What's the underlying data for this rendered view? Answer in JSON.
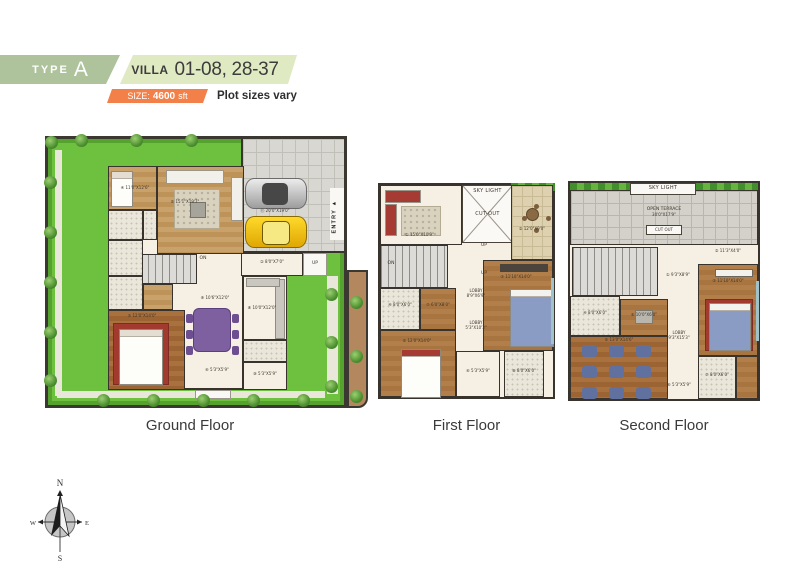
{
  "header": {
    "type_label": "TYPE",
    "type_value": "A",
    "villa_label": "VILLA",
    "villa_numbers": "01-08, 28-37",
    "size_label": "SIZE:",
    "size_value": "4600",
    "size_unit": "sft",
    "plot_note": "Plot sizes vary",
    "colors": {
      "band_dark": "#aec39b",
      "band_light": "#dfe9c2",
      "size_badge": "#f28048"
    }
  },
  "floors": {
    "ground": {
      "label": "Ground Floor",
      "entry": "ENTRY ▲",
      "on": "ON",
      "up": "UP",
      "rooms": {
        "bed2": "④ 11'0\"X12'6\"",
        "living": "⑤ 15'1\"X19'7\"",
        "sitout": "② 8'0\"X7'0\"",
        "carpark": "⑪ 20'0\"X19'0\"",
        "dining": "⑨ 10'6\"X12'0\"",
        "kitchen": "⑧ 10'0\"X12'0\"",
        "master": "③ 12'0\"X14'0\"",
        "utility": "⑩ 5'3\"X5'9\"",
        "foyer": "⑥ 5'3\"X5'9\""
      }
    },
    "first": {
      "label": "First Floor",
      "sky_light": "SKY LIGHT",
      "cut_out": "CUT-OUT",
      "on": "ON",
      "up": "UP",
      "rooms": {
        "family": "① 15'0\"X10'9\"",
        "terrace": "② 12'0\"X9'0\"",
        "bed3": "③ 11'10\"X14'0\"",
        "bath4": "④ 8'0\"X6'0\"",
        "bed5": "⑤ 12'0\"X14'0\"",
        "store6": "⑥ 5'3\"X5'9\"",
        "dress7": "⑦ 6'0\"X8'0\"",
        "bath8": "⑧ 8'0\"X6'0\"",
        "lobby_a": "LOBBY 8'9\"X6'9\"",
        "lobby_b": "LOBBY 5'3\"X10'3\""
      }
    },
    "second": {
      "label": "Second Floor",
      "sky_light": "SKY LIGHT",
      "open_terrace": "OPEN TERRACE",
      "terrace_dim": "30'0\"X17'9\"",
      "cut_out": "CUT OUT",
      "rooms": {
        "lobby_a": "① 9'3\"X8'9\"",
        "pass": "② 11'3\"X4'0\"",
        "bed3": "③ 11'10\"X14'0\"",
        "bath4": "④ 8'0\"X6'0\"",
        "theater": "⑤ 13'0\"X14'6\"",
        "av": "⑥ 10'0\"X6'0\"",
        "bath7": "⑦ 8'0\"X6'0\"",
        "store": "⑥ 5'3\"X5'9\"",
        "lobby_b": "LOBBY 9'3\"X15'3\""
      }
    }
  },
  "compass": {
    "n": "N",
    "e": "E",
    "s": "S",
    "w": "W"
  }
}
